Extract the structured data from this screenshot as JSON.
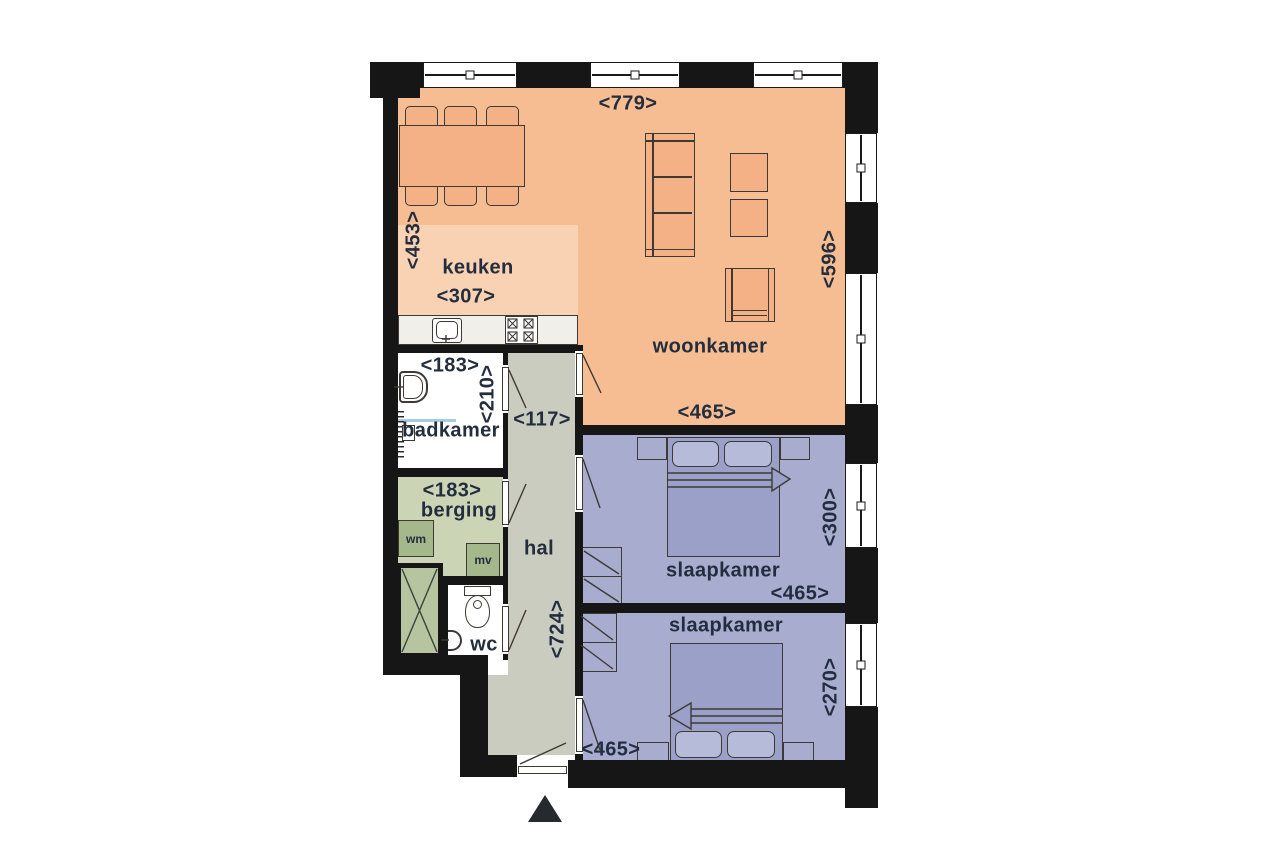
{
  "plan_title": "apartment-floor-plan",
  "rooms": {
    "woonkamer": {
      "name": "woonkamer",
      "width_label": "<779>",
      "height_label": "<596>",
      "inner_width_label": "<465>"
    },
    "keuken": {
      "name": "keuken",
      "height_label": "<453>",
      "width_label": "<307>"
    },
    "badkamer": {
      "name": "badkamer",
      "width_label": "<183>",
      "height_label": "<210>"
    },
    "berging": {
      "name": "berging",
      "width_label": "<183>"
    },
    "hal": {
      "name": "hal",
      "width_label": "<117>",
      "height_label": "<724>"
    },
    "wc": {
      "name": "wc"
    },
    "slaapkamer_1": {
      "name": "slaapkamer",
      "width_label": "<465>",
      "height_label": "<300>"
    },
    "slaapkamer_2": {
      "name": "slaapkamer",
      "width_label": "<465>",
      "height_label": "<270>"
    }
  },
  "appliances": {
    "washing_machine_label": "wm",
    "mechanical_ventilation_label": "mv"
  },
  "colors": {
    "wall": "#161616",
    "woonkamer": "#f6bd93",
    "keuken": "#f9d2b4",
    "slaapkamer": "#a8adcf",
    "hal": "#cbccc0",
    "berging": "#ccd4b6",
    "appliance": "#a5b88b",
    "shaft": "#b6c4a0",
    "wetroom": "#ffffff",
    "counter": "#f0efe9",
    "furn_orange": "#f3b185",
    "furn_purple": "#9aa0c8",
    "pillow": "#b6bbd9",
    "outline": "#3d3a36",
    "text": "#232d3d",
    "shower_line": "#a6cde4"
  }
}
